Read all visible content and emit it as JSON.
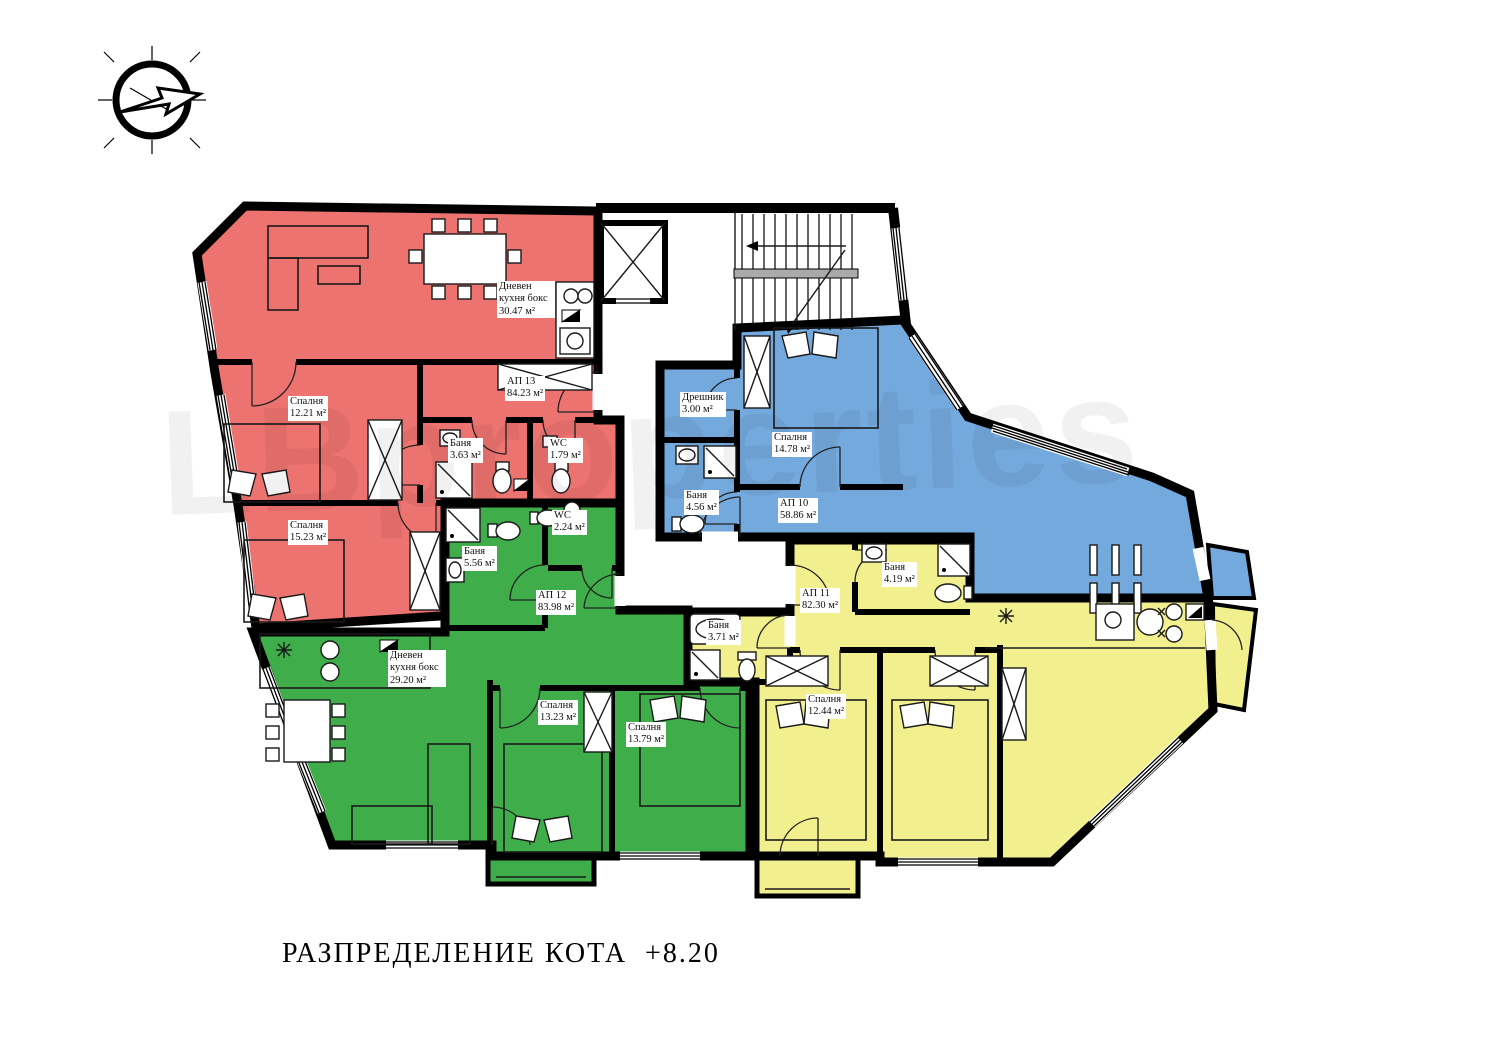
{
  "title": "РАЗПРЕДЕЛЕНИЕ КОТА  +8.20",
  "watermark": "LBproperties",
  "colors": {
    "red": "#ed7370",
    "green": "#3fae4a",
    "blue": "#74a9de",
    "yellow": "#f2ef8f",
    "wall": "#000000"
  },
  "apartments": [
    {
      "id": "АП 13",
      "area": "84.23 м²",
      "color": "#ed7370"
    },
    {
      "id": "АП 10",
      "area": "58.86 м²",
      "color": "#74a9de"
    },
    {
      "id": "АП 12",
      "area": "83.98 м²",
      "color": "#3fae4a"
    },
    {
      "id": "АП 11",
      "area": "82.30 м²",
      "color": "#f2ef8f"
    }
  ],
  "rooms": [
    {
      "name": "Дневен кухня бокс",
      "area": "30.47 м²"
    },
    {
      "name": "Спалня",
      "area": "12.21 м²"
    },
    {
      "name": "Баня",
      "area": "3.63 м²"
    },
    {
      "name": "WC",
      "area": "1.79 м²"
    },
    {
      "name": "Спалня",
      "area": "15.23 м²"
    },
    {
      "name": "Дрешник",
      "area": "3.00 м²"
    },
    {
      "name": "Спалня",
      "area": "14.78 м²"
    },
    {
      "name": "Баня",
      "area": "4.56 м²"
    },
    {
      "name": "WC",
      "area": "2.24 м²"
    },
    {
      "name": "Баня",
      "area": "5.56 м²"
    },
    {
      "name": "Дневен кухня бокс",
      "area": "29.20 м²"
    },
    {
      "name": "Спалня",
      "area": "13.23 м²"
    },
    {
      "name": "Спалня",
      "area": "13.79 м²"
    },
    {
      "name": "Баня",
      "area": "4.19 м²"
    },
    {
      "name": "Баня",
      "area": "3.71 м²"
    },
    {
      "name": "Спалня",
      "area": "12.44 м²"
    }
  ]
}
